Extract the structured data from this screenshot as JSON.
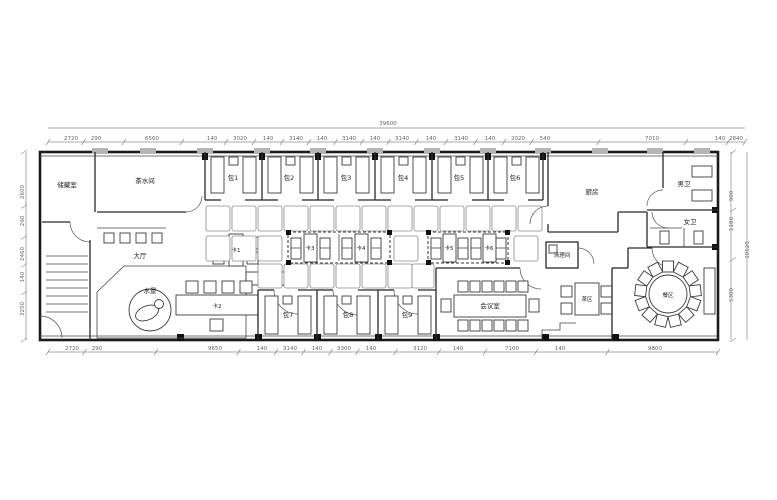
{
  "rooms": {
    "storage": "储藏室",
    "tea": "茶水间",
    "hall": "大厅",
    "water": "水景",
    "p1": "包1",
    "p2": "包2",
    "p3": "包3",
    "p4": "包4",
    "p5": "包5",
    "p6": "包6",
    "p7": "包7",
    "p8": "包8",
    "p9": "包9",
    "k1": "卡1",
    "k2": "卡2",
    "k3": "卡3",
    "k4": "卡4",
    "k5": "卡5",
    "k6": "卡6",
    "meeting": "会议室",
    "cleaning": "清理间",
    "kitchen": "厨房",
    "wc_m": "男卫",
    "wc_f": "女卫",
    "tea_area": "茶区",
    "dining": "餐区"
  },
  "dims": {
    "total_top": "39600",
    "total_right": "10520",
    "top": [
      {
        "v": "2720",
        "x": 71
      },
      {
        "v": "290",
        "x": 96
      },
      {
        "v": "6560",
        "x": 152
      },
      {
        "v": "140",
        "x": 212
      },
      {
        "v": "3020",
        "x": 240
      },
      {
        "v": "140",
        "x": 268
      },
      {
        "v": "3140",
        "x": 296
      },
      {
        "v": "140",
        "x": 322
      },
      {
        "v": "3140",
        "x": 349
      },
      {
        "v": "140",
        "x": 375
      },
      {
        "v": "3140",
        "x": 402
      },
      {
        "v": "140",
        "x": 431
      },
      {
        "v": "3140",
        "x": 461
      },
      {
        "v": "140",
        "x": 490
      },
      {
        "v": "2020",
        "x": 518
      },
      {
        "v": "540",
        "x": 545
      },
      {
        "v": "7010",
        "x": 652
      },
      {
        "v": "140",
        "x": 720
      },
      {
        "v": "2840",
        "x": 736
      }
    ],
    "bottom": [
      {
        "v": "2720",
        "x": 72
      },
      {
        "v": "290",
        "x": 97
      },
      {
        "v": "9650",
        "x": 215
      },
      {
        "v": "140",
        "x": 262
      },
      {
        "v": "3140",
        "x": 290
      },
      {
        "v": "140",
        "x": 317
      },
      {
        "v": "3300",
        "x": 344
      },
      {
        "v": "140",
        "x": 371
      },
      {
        "v": "3120",
        "x": 420
      },
      {
        "v": "140",
        "x": 458
      },
      {
        "v": "7100",
        "x": 512
      },
      {
        "v": "140",
        "x": 560
      },
      {
        "v": "9800",
        "x": 655
      }
    ],
    "left": [
      {
        "v": "2600",
        "y": 192
      },
      {
        "v": "290",
        "y": 221
      },
      {
        "v": "2460",
        "y": 254
      },
      {
        "v": "140",
        "y": 277
      },
      {
        "v": "3250",
        "y": 309
      }
    ],
    "right": [
      {
        "v": "900",
        "y": 196
      },
      {
        "v": "1180",
        "y": 224
      },
      {
        "v": "5300",
        "y": 295
      }
    ]
  }
}
